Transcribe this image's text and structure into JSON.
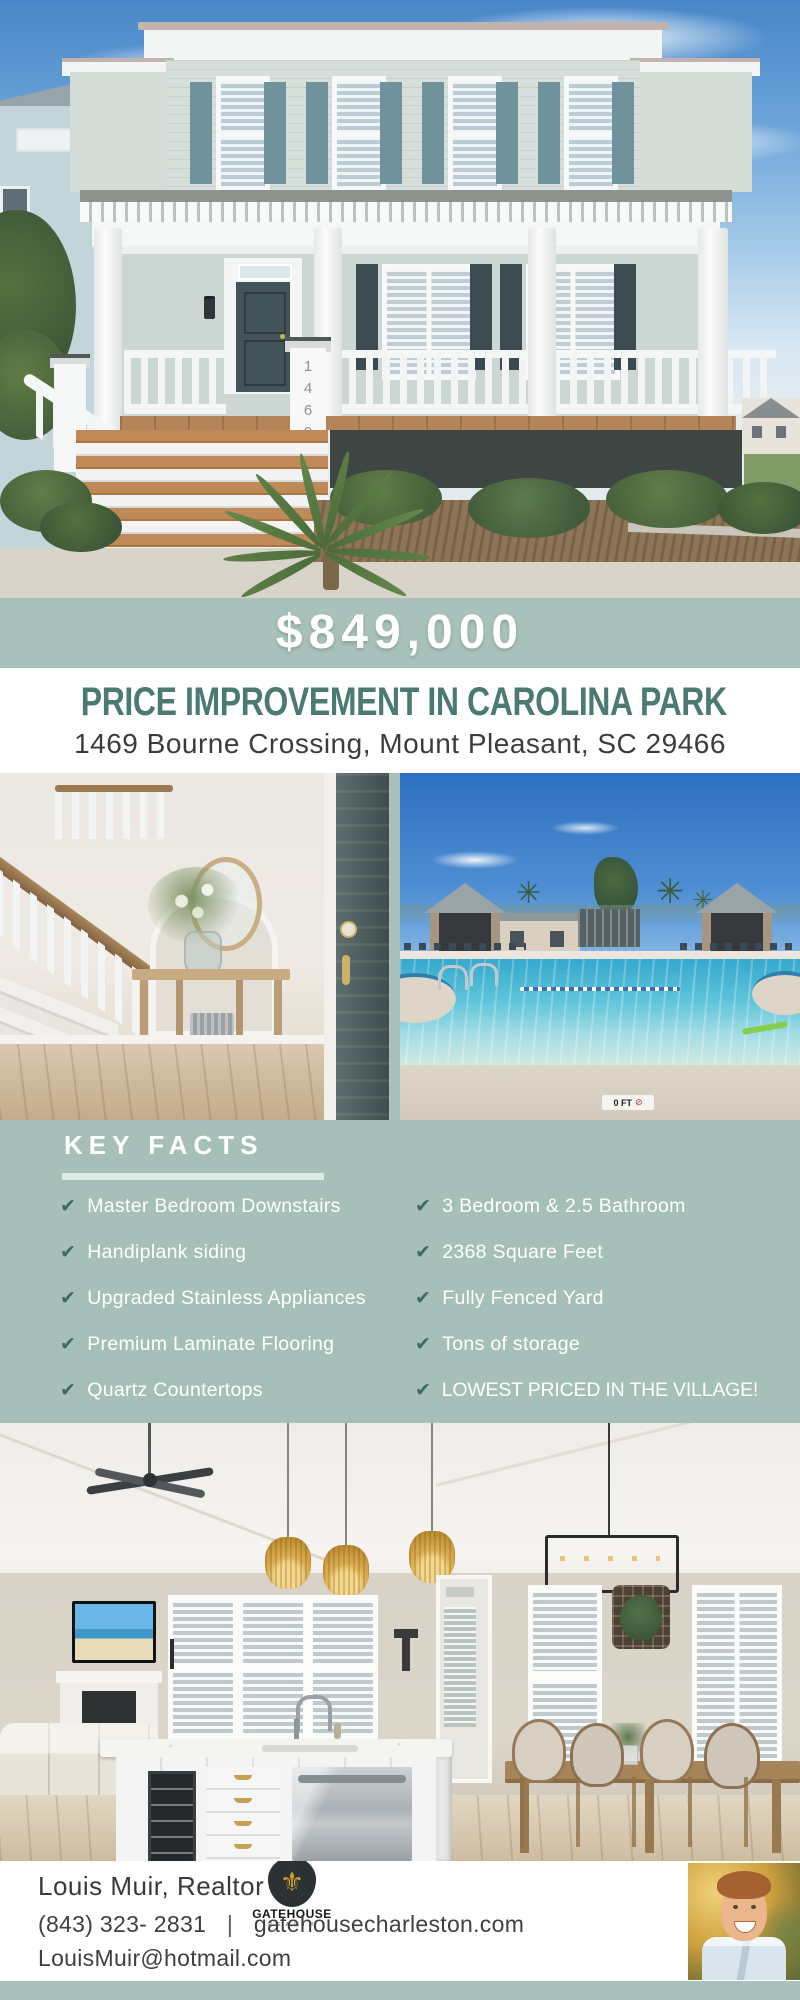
{
  "banner": {
    "price": "$849,000"
  },
  "headline": {
    "title": "PRICE IMPROVEMENT IN CAROLINA PARK",
    "address": "1469 Bourne Crossing, Mount Pleasant, SC 29466"
  },
  "hero": {
    "house_number": "1469"
  },
  "photos": {
    "pool_sign": "0 FT"
  },
  "key_facts": {
    "title": "KEY FACTS",
    "left": [
      "Master Bedroom Downstairs",
      "Handiplank siding",
      "Upgraded Stainless Appliances",
      "Premium Laminate Flooring",
      "Quartz Countertops"
    ],
    "right": [
      "3 Bedroom & 2.5 Bathroom",
      "2368 Square Feet",
      "Fully Fenced Yard",
      "Tons of storage",
      "LOWEST PRICED IN THE VILLAGE!"
    ]
  },
  "footer": {
    "name": "Louis Muir, Realtor",
    "brokerage": "GATEHOUSE",
    "brokerage_sub": "R E A L T Y",
    "phone": "(843) 323- 2831",
    "separator": "|",
    "website": "gatehousecharleston.com",
    "email": "LouisMuir@hotmail.com"
  },
  "icons": {
    "check": "✔",
    "crest": "⚜",
    "no_diving": "⊘",
    "palm": "✳"
  },
  "colors": {
    "sage_banner": "#a9c1bb",
    "teal_heading": "#4b7a73",
    "check_teal": "#3f6a62",
    "underline": "#dcebe6",
    "logo_gold": "#c79b2e",
    "logo_charcoal": "#2c3133",
    "body_text": "#3c3c3c"
  }
}
